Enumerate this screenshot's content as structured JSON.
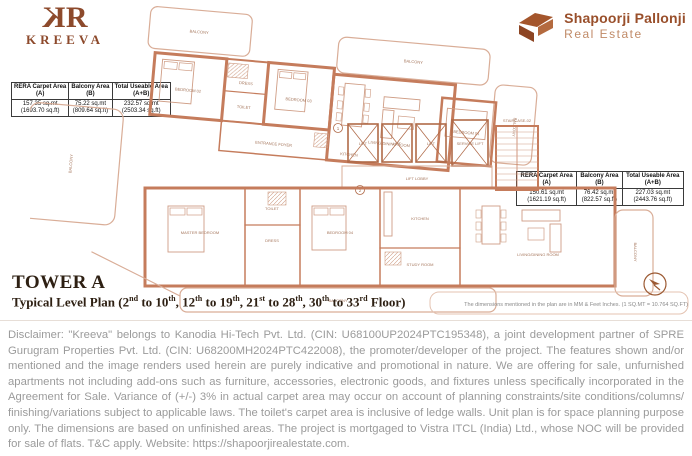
{
  "brand": {
    "mono_left": "K",
    "mono_right": "R",
    "name": "KREEVA",
    "accent_color": "#8d4a2c"
  },
  "developer": {
    "name": "Shapoorji Pallonji",
    "division": "Real Estate",
    "mark_color": "#9c4f26"
  },
  "tables": {
    "left": {
      "columns": [
        {
          "header": "RERA Carpet Area",
          "sub": "(A)",
          "value": "157.35 sq.mt",
          "value2": "(1693.70 sq.ft)"
        },
        {
          "header": "Balcony Area",
          "sub": "(B)",
          "value": "75.22 sq.mt",
          "value2": "(809.64 sq.ft)"
        },
        {
          "header": "Total Useable Area",
          "sub": "(A+B)",
          "value": "232.57 sq.mt",
          "value2": "(2503.34 sq.ft)"
        }
      ]
    },
    "right": {
      "columns": [
        {
          "header": "RERA Carpet Area",
          "sub": "(A)",
          "value": "150.61 sq.mt",
          "value2": "(1621.19 sq.ft)"
        },
        {
          "header": "Balcony Area",
          "sub": "(B)",
          "value": "76.42 sq.mt",
          "value2": "(822.57 sq.ft)"
        },
        {
          "header": "Total Useable Area",
          "sub": "(A+B)",
          "value": "227.03 sq.mt",
          "value2": "(2443.76 sq.ft)"
        }
      ]
    }
  },
  "title": {
    "tower": "TOWER A",
    "plan_segments": [
      {
        "t": "Typical Level Plan (2"
      },
      {
        "sup": "nd"
      },
      {
        "t": " to 10"
      },
      {
        "sup": "th"
      },
      {
        "t": ", 12"
      },
      {
        "sup": "th"
      },
      {
        "t": " to 19"
      },
      {
        "sup": "th"
      },
      {
        "t": ", 21"
      },
      {
        "sup": "st"
      },
      {
        "t": " to 28"
      },
      {
        "sup": "th"
      },
      {
        "t": ", 30"
      },
      {
        "sup": "th"
      },
      {
        "t": " to 33"
      },
      {
        "sup": "rd"
      },
      {
        "t": " Floor)"
      }
    ]
  },
  "dimension_note": "The dimensions mentioned in the plan are in MM & Feet Inches. (1 SQ.MT = 10.764 SQ.FT)",
  "disclaimer": "Disclaimer: \"Kreeva\" belongs to Kanodia Hi-Tech Pvt. Ltd. (CIN: U68100UP2024PTC195348), a joint development partner of SPRE Gurugram Properties Pvt. Ltd. (CIN: U68200MH2024PTC422008), the promoter/developer of the project. The features shown and/or mentioned and the image renders used herein are purely indicative and promotional in nature. We are offering for sale, unfurnished apartments not including add-ons such as furniture, accessories, electronic goods, and fixtures unless specifically incorporated in the Agreement for Sale. Variance of (+/-) 3% in actual carpet area may occur on account of planning constraints/site conditions/columns/ finishing/variations subject to applicable laws. The toilet's carpet area is inclusive of ledge walls. Unit plan is for space planning purpose only. The dimensions are based on unfinished areas. The project is mortgaged to Vistra ITCL (India) Ltd., whose NOC will be provided for sale of flats. T&C apply. Website: https://shapoorjirealestate.com.",
  "plan": {
    "wall_color": "#c57c5c",
    "labels": [
      "BALCONY",
      "BEDROOM 02",
      "DRESS",
      "TOILET",
      "BEDROOM 03",
      "BALCONY",
      "LIVING/DINING ROOM",
      "KITCHEN",
      "BEDROOM 01",
      "BALCONY",
      "LIFT",
      "LIFT",
      "LIFT",
      "SERVICE LIFT",
      "STAIRCASE-02",
      "LIFT LOBBY",
      "BALCONY",
      "MASTER BEDROOM",
      "TOILET",
      "DRESS",
      "BEDROOM 04",
      "KITCHEN",
      "STUDY ROOM",
      "LIVING/DINING ROOM",
      "BALCONY",
      "BALCONY",
      "ENTRANCE FOYER"
    ],
    "entry_markers": [
      "1",
      "2"
    ]
  }
}
